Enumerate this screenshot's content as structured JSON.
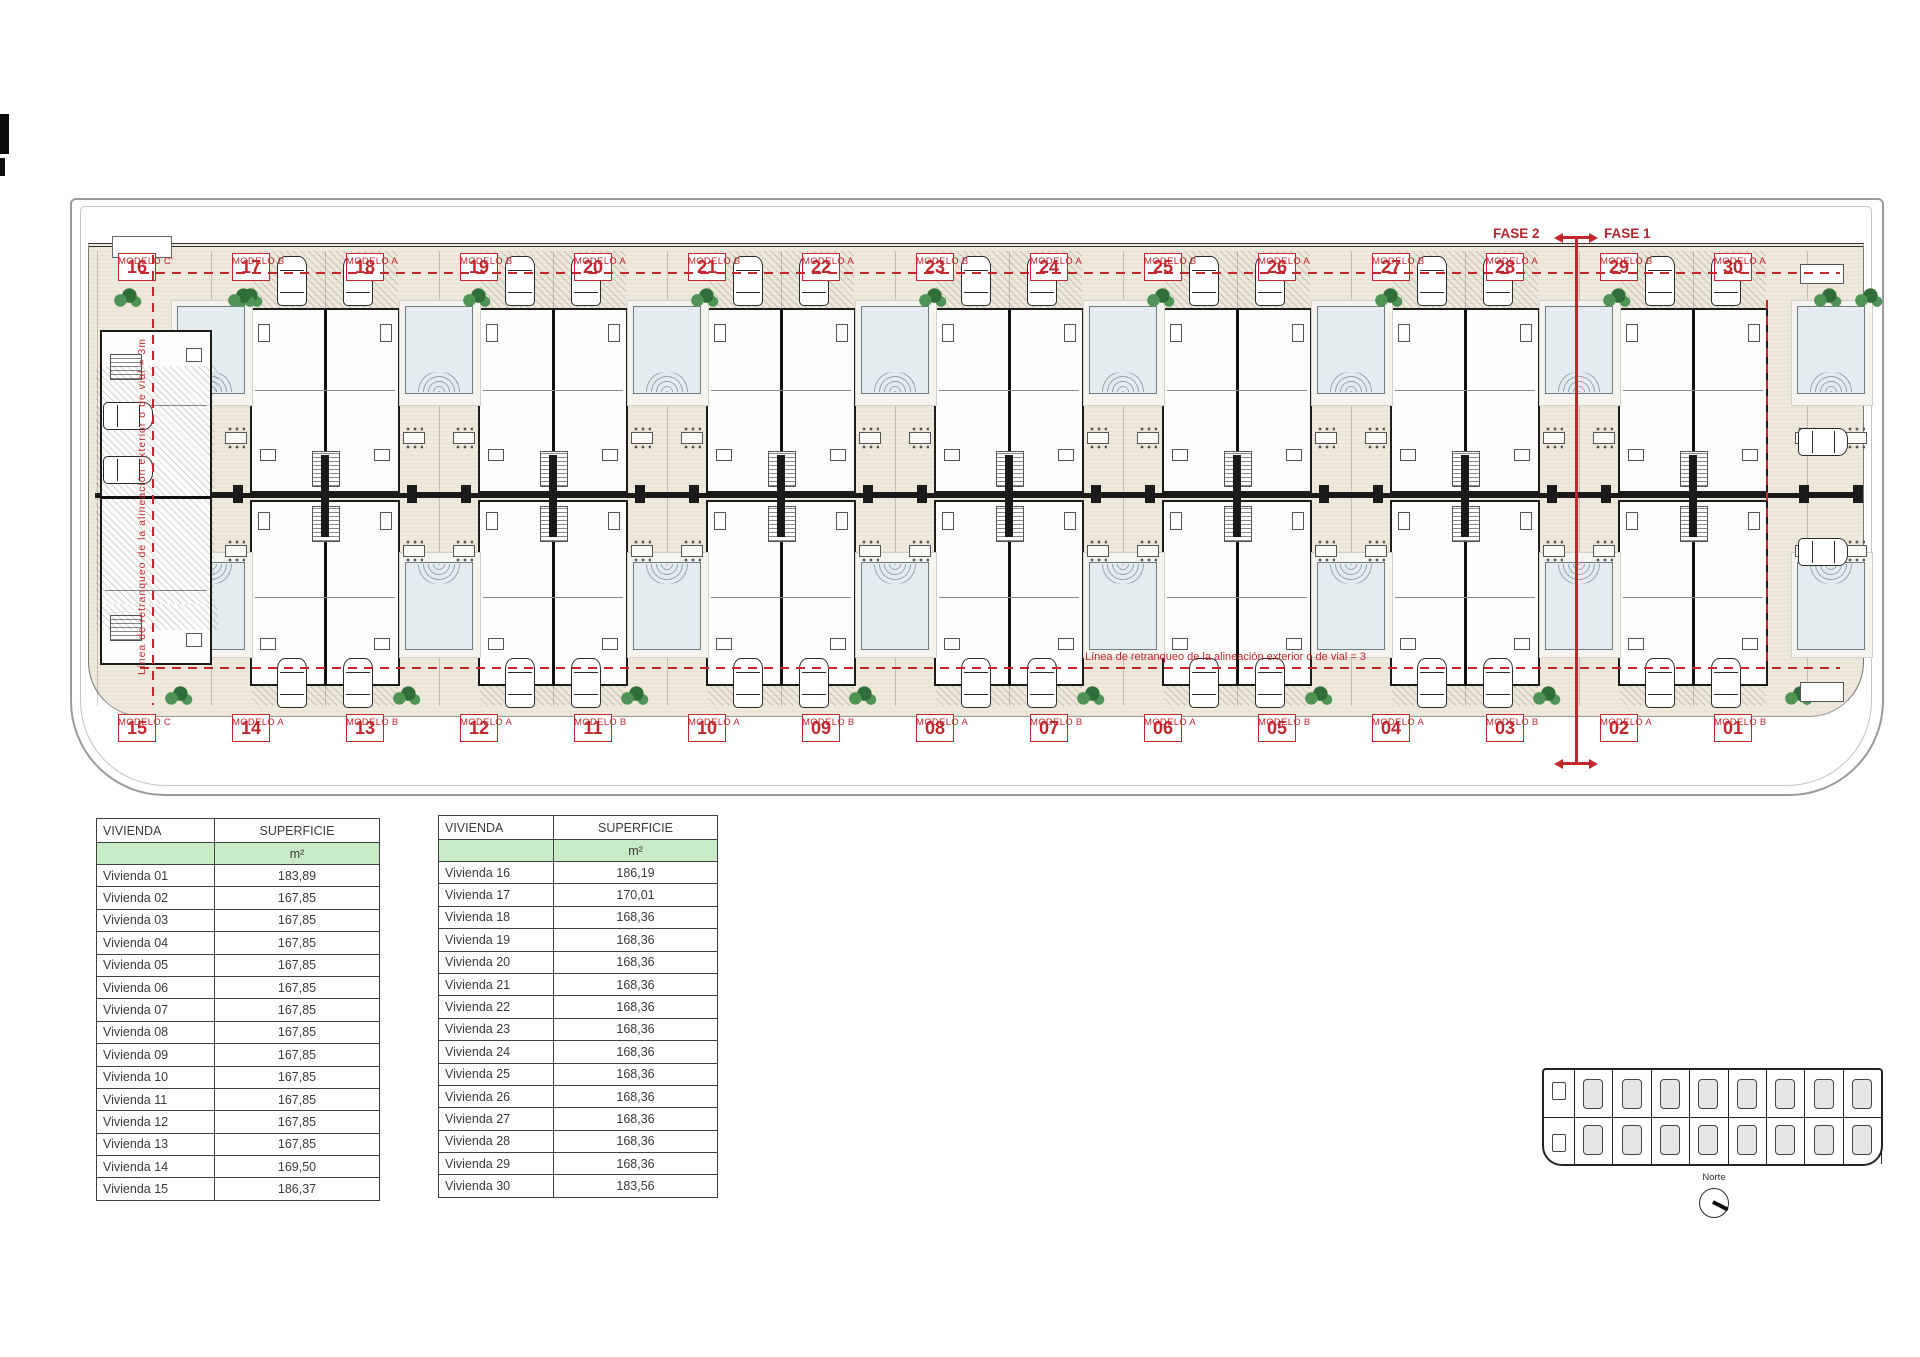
{
  "plan": {
    "fase1_label": "FASE 1",
    "fase2_label": "FASE 2",
    "setback_note_horizontal": "Línea de retranqueo de la alineación exterior o de vial = 3",
    "setback_note_vertical": "Línea de retranqueo de la alineación exterior o de vial = 3m",
    "top_units": [
      {
        "number": "16",
        "model": "MODELO C'"
      },
      {
        "number": "17",
        "model": "MODELO B"
      },
      {
        "number": "18",
        "model": "MODELO A"
      },
      {
        "number": "19",
        "model": "MODELO B"
      },
      {
        "number": "20",
        "model": "MODELO A"
      },
      {
        "number": "21",
        "model": "MODELO B"
      },
      {
        "number": "22",
        "model": "MODELO A"
      },
      {
        "number": "23",
        "model": "MODELO B"
      },
      {
        "number": "24",
        "model": "MODELO A"
      },
      {
        "number": "25",
        "model": "MODELO B"
      },
      {
        "number": "26",
        "model": "MODELO A"
      },
      {
        "number": "27",
        "model": "MODELO B"
      },
      {
        "number": "28",
        "model": "MODELO A"
      },
      {
        "number": "29",
        "model": "MODELO B"
      },
      {
        "number": "30",
        "model": "MODELO A"
      }
    ],
    "bottom_units": [
      {
        "number": "15",
        "model": "MODELO C"
      },
      {
        "number": "14",
        "model": "MODELO A"
      },
      {
        "number": "13",
        "model": "MODELO B"
      },
      {
        "number": "12",
        "model": "MODELO A"
      },
      {
        "number": "11",
        "model": "MODELO B"
      },
      {
        "number": "10",
        "model": "MODELO A"
      },
      {
        "number": "09",
        "model": "MODELO B"
      },
      {
        "number": "08",
        "model": "MODELO A"
      },
      {
        "number": "07",
        "model": "MODELO B"
      },
      {
        "number": "06",
        "model": "MODELO A"
      },
      {
        "number": "05",
        "model": "MODELO B"
      },
      {
        "number": "04",
        "model": "MODELO A"
      },
      {
        "number": "03",
        "model": "MODELO B"
      },
      {
        "number": "02",
        "model": "MODELO A"
      },
      {
        "number": "01",
        "model": "MODELO B"
      }
    ]
  },
  "tables": [
    {
      "name": "superficie-table-01-15",
      "headers": [
        "VIVIENDA",
        "SUPERFICIE"
      ],
      "unit_label": "m²",
      "rows": [
        [
          "Vivienda 01",
          "183,89"
        ],
        [
          "Vivienda 02",
          "167,85"
        ],
        [
          "Vivienda 03",
          "167,85"
        ],
        [
          "Vivienda 04",
          "167,85"
        ],
        [
          "Vivienda 05",
          "167,85"
        ],
        [
          "Vivienda 06",
          "167,85"
        ],
        [
          "Vivienda 07",
          "167,85"
        ],
        [
          "Vivienda 08",
          "167,85"
        ],
        [
          "Vivienda 09",
          "167,85"
        ],
        [
          "Vivienda 10",
          "167,85"
        ],
        [
          "Vivienda 11",
          "167,85"
        ],
        [
          "Vivienda 12",
          "167,85"
        ],
        [
          "Vivienda 13",
          "167,85"
        ],
        [
          "Vivienda 14",
          "169,50"
        ],
        [
          "Vivienda 15",
          "186,37"
        ]
      ]
    },
    {
      "name": "superficie-table-16-30",
      "headers": [
        "VIVIENDA",
        "SUPERFICIE"
      ],
      "unit_label": "m²",
      "rows": [
        [
          "Vivienda 16",
          "186,19"
        ],
        [
          "Vivienda 17",
          "170,01"
        ],
        [
          "Vivienda 18",
          "168,36"
        ],
        [
          "Vivienda 19",
          "168,36"
        ],
        [
          "Vivienda 20",
          "168,36"
        ],
        [
          "Vivienda 21",
          "168,36"
        ],
        [
          "Vivienda 22",
          "168,36"
        ],
        [
          "Vivienda 23",
          "168,36"
        ],
        [
          "Vivienda 24",
          "168,36"
        ],
        [
          "Vivienda 25",
          "168,36"
        ],
        [
          "Vivienda 26",
          "168,36"
        ],
        [
          "Vivienda 27",
          "168,36"
        ],
        [
          "Vivienda 28",
          "168,36"
        ],
        [
          "Vivienda 29",
          "168,36"
        ],
        [
          "Vivienda 30",
          "183,56"
        ]
      ]
    }
  ],
  "keyplan": {
    "north_label": "Norte"
  },
  "colors": {
    "accent_red": "#c1272d",
    "paving": "#efe9dc",
    "pool_blue": "#e4ecef",
    "tree_green": "#2f6e38",
    "table_green": "#c9ebc5",
    "wall_black": "#1c1c1c"
  }
}
